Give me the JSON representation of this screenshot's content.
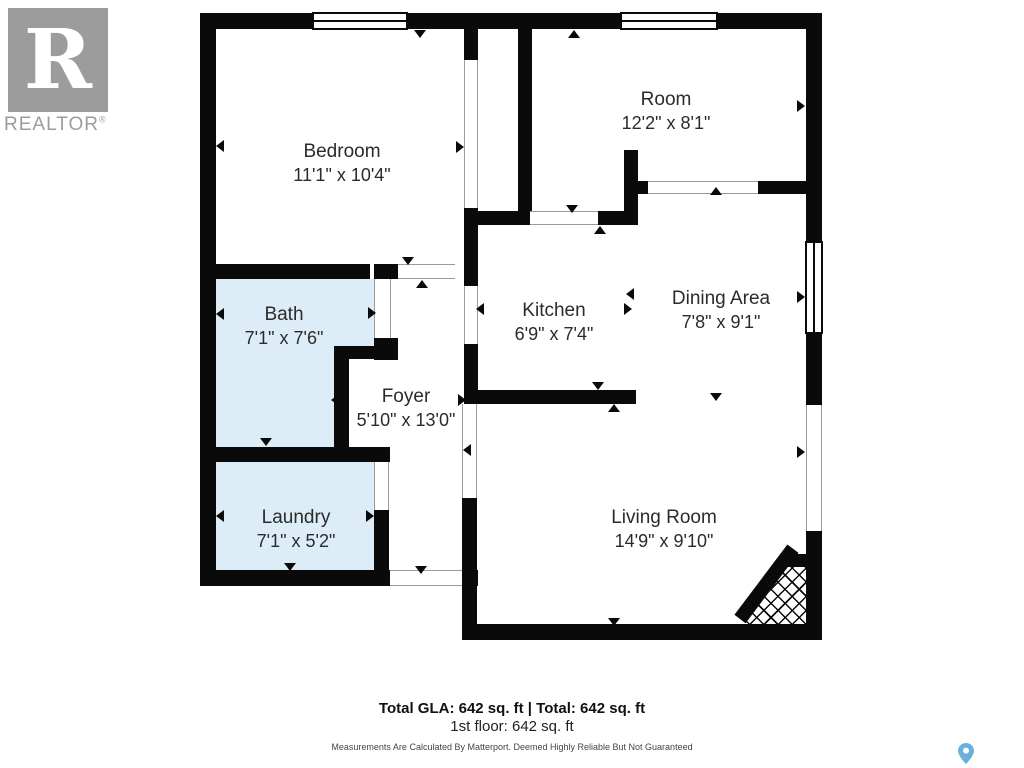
{
  "logo": {
    "letter": "R",
    "wordmark": "REALTOR",
    "registered": "®"
  },
  "rooms": [
    {
      "name": "Bedroom",
      "dims": "11'1\" x 10'4\""
    },
    {
      "name": "Room",
      "dims": "12'2\" x 8'1\""
    },
    {
      "name": "Bath",
      "dims": "7'1\" x 7'6\""
    },
    {
      "name": "Kitchen",
      "dims": "6'9\" x 7'4\""
    },
    {
      "name": "Dining Area",
      "dims": "7'8\" x 9'1\""
    },
    {
      "name": "Foyer",
      "dims": "5'10\" x 13'0\""
    },
    {
      "name": "Laundry",
      "dims": "7'1\" x 5'2\""
    },
    {
      "name": "Living Room",
      "dims": "14'9\" x 9'10\""
    }
  ],
  "footer": {
    "total_line": "Total GLA: 642 sq. ft | Total: 642 sq. ft",
    "floor_line": "1st floor: 642 sq. ft",
    "disclaimer": "Measurements Are Calculated By Matterport. Deemed Highly Reliable But Not Guaranteed"
  },
  "colors": {
    "wall": "#0a0a0a",
    "wet_room_fill": "#ddedf7",
    "logo_gray": "#9c9c9c",
    "pin_blue": "#68b2da"
  }
}
